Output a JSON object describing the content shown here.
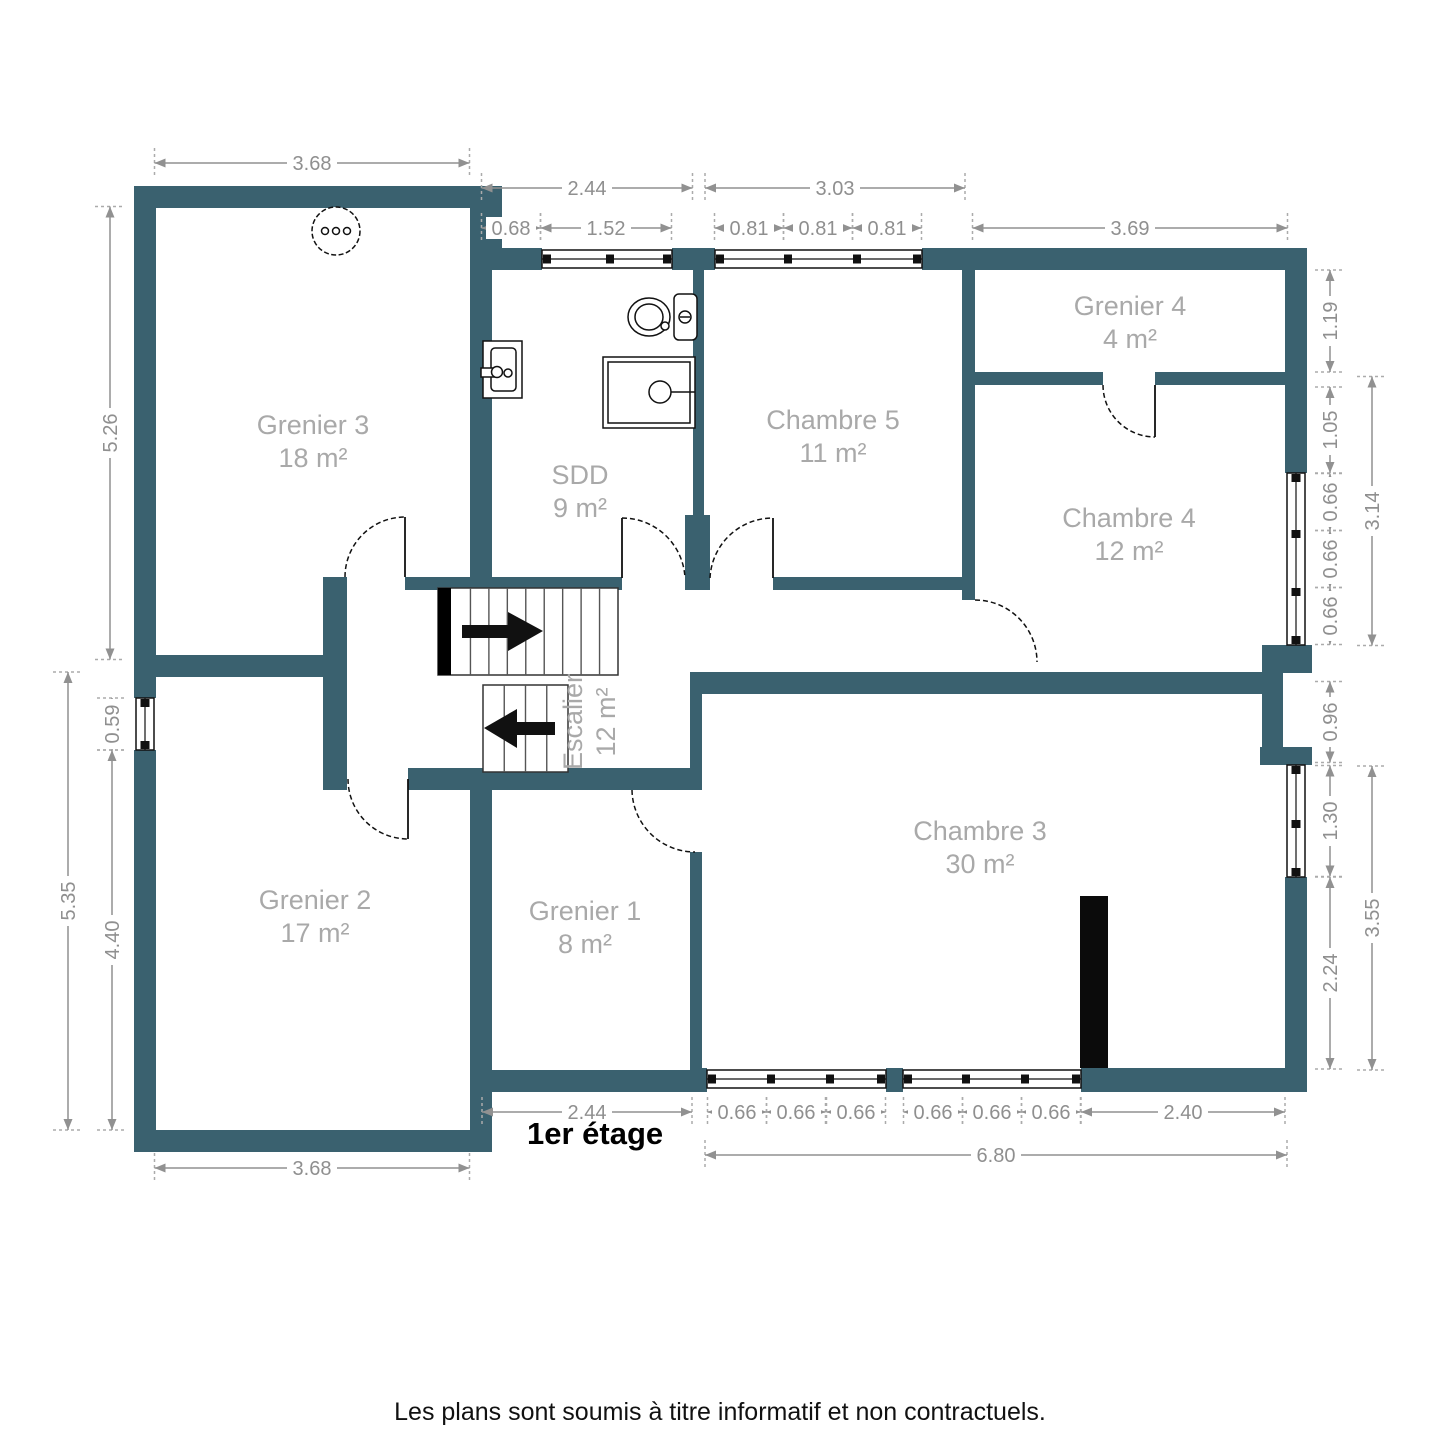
{
  "title": "1er étage",
  "footer": "Les plans sont soumis à titre informatif et non contractuels.",
  "colors": {
    "wall": "#3A616F",
    "dim": "#8F8F8F",
    "room_label": "#A9A9A9",
    "text": "#111111"
  },
  "rooms": [
    {
      "id": "grenier-3",
      "name": "Grenier 3",
      "area": "18 m²",
      "cx": 313,
      "cy": 442,
      "rotated": false
    },
    {
      "id": "sdd",
      "name": "SDD",
      "area": "9 m²",
      "cx": 580,
      "cy": 492,
      "rotated": false
    },
    {
      "id": "chambre-5",
      "name": "Chambre 5",
      "area": "11 m²",
      "cx": 833,
      "cy": 437,
      "rotated": false
    },
    {
      "id": "grenier-4",
      "name": "Grenier 4",
      "area": "4 m²",
      "cx": 1130,
      "cy": 323,
      "rotated": false
    },
    {
      "id": "chambre-4",
      "name": "Chambre 4",
      "area": "12 m²",
      "cx": 1129,
      "cy": 535,
      "rotated": false
    },
    {
      "id": "grenier-2",
      "name": "Grenier 2",
      "area": "17 m²",
      "cx": 315,
      "cy": 917,
      "rotated": false
    },
    {
      "id": "grenier-1",
      "name": "Grenier 1",
      "area": "8 m²",
      "cx": 585,
      "cy": 928,
      "rotated": false
    },
    {
      "id": "escalier",
      "name": "Escalier",
      "area": "12 m²",
      "cx": 590,
      "cy": 722,
      "rotated": true
    },
    {
      "id": "chambre-3",
      "name": "Chambre 3",
      "area": "30 m²",
      "cx": 980,
      "cy": 848,
      "rotated": false
    }
  ],
  "dimensions": [
    {
      "t": "3.68",
      "o": "h",
      "x": 312,
      "y": 163,
      "l": 315
    },
    {
      "t": "2.44",
      "o": "h",
      "x": 587,
      "y": 188,
      "l": 211
    },
    {
      "t": "0.68",
      "o": "h",
      "x": 511,
      "y": 228,
      "l": 59
    },
    {
      "t": "1.52",
      "o": "h",
      "x": 606,
      "y": 228,
      "l": 131
    },
    {
      "t": "3.03",
      "o": "h",
      "x": 835,
      "y": 188,
      "l": 260
    },
    {
      "t": "0.81",
      "o": "h",
      "x": 749,
      "y": 228,
      "l": 69
    },
    {
      "t": "0.81",
      "o": "h",
      "x": 818,
      "y": 228,
      "l": 69
    },
    {
      "t": "0.81",
      "o": "h",
      "x": 887,
      "y": 228,
      "l": 69
    },
    {
      "t": "3.69",
      "o": "h",
      "x": 1130,
      "y": 228,
      "l": 315
    },
    {
      "t": "5.26",
      "o": "v",
      "x": 110,
      "y": 433,
      "l": 453
    },
    {
      "t": "0.59",
      "o": "v",
      "x": 112,
      "y": 724,
      "l": 52
    },
    {
      "t": "4.40",
      "o": "v",
      "x": 112,
      "y": 940,
      "l": 380
    },
    {
      "t": "5.35",
      "o": "v",
      "x": 68,
      "y": 901,
      "l": 458
    },
    {
      "t": "1.19",
      "o": "v",
      "x": 1330,
      "y": 321,
      "l": 102
    },
    {
      "t": "1.05",
      "o": "v",
      "x": 1330,
      "y": 430,
      "l": 86
    },
    {
      "t": "0.66",
      "o": "v",
      "x": 1330,
      "y": 502,
      "l": 57
    },
    {
      "t": "0.66",
      "o": "v",
      "x": 1330,
      "y": 559,
      "l": 57
    },
    {
      "t": "0.66",
      "o": "v",
      "x": 1330,
      "y": 616,
      "l": 57
    },
    {
      "t": "3.14",
      "o": "v",
      "x": 1372,
      "y": 511,
      "l": 269
    },
    {
      "t": "0.96",
      "o": "v",
      "x": 1330,
      "y": 722,
      "l": 81
    },
    {
      "t": "1.30",
      "o": "v",
      "x": 1330,
      "y": 821,
      "l": 111
    },
    {
      "t": "2.24",
      "o": "v",
      "x": 1330,
      "y": 973,
      "l": 192
    },
    {
      "t": "3.55",
      "o": "v",
      "x": 1372,
      "y": 918,
      "l": 304
    },
    {
      "t": "2.44",
      "o": "h",
      "x": 587,
      "y": 1112,
      "l": 210
    },
    {
      "t": "0.66",
      "o": "h",
      "x": 737,
      "y": 1112,
      "l": 59
    },
    {
      "t": "0.66",
      "o": "h",
      "x": 796,
      "y": 1112,
      "l": 59
    },
    {
      "t": "0.66",
      "o": "h",
      "x": 856,
      "y": 1112,
      "l": 59
    },
    {
      "t": "0.66",
      "o": "h",
      "x": 933,
      "y": 1112,
      "l": 59
    },
    {
      "t": "0.66",
      "o": "h",
      "x": 992,
      "y": 1112,
      "l": 59
    },
    {
      "t": "0.66",
      "o": "h",
      "x": 1051,
      "y": 1112,
      "l": 59
    },
    {
      "t": "2.40",
      "o": "h",
      "x": 1183,
      "y": 1112,
      "l": 204
    },
    {
      "t": "6.80",
      "o": "h",
      "x": 996,
      "y": 1155,
      "l": 582
    },
    {
      "t": "3.68",
      "o": "h",
      "x": 312,
      "y": 1168,
      "l": 315
    }
  ],
  "fixtures": [
    "ceiling-light",
    "toilet",
    "sink",
    "shower",
    "chimney",
    "staircase-up",
    "staircase-down"
  ]
}
